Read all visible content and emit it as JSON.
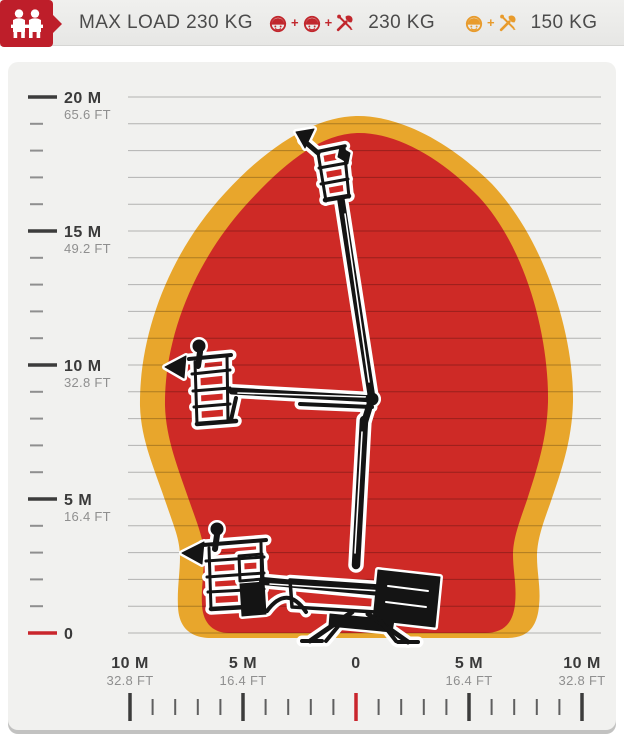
{
  "header": {
    "max_load_text": "MAX LOAD 230 KG",
    "plus": "+",
    "capacities": [
      {
        "formula": "worker + worker + tools",
        "value": "230 KG",
        "color": "#C1272D"
      },
      {
        "formula": "worker + tools",
        "value": "150 KG",
        "color": "#E89B2C"
      }
    ]
  },
  "chart_data": {
    "type": "area",
    "title": "Aerial work platform working envelope (height vs outreach)",
    "grid": true,
    "x_axis": {
      "unit": "M / FT",
      "range_m": [
        -10,
        10
      ],
      "minor_step_m": 1,
      "ticks": [
        {
          "v": -10,
          "m": "10 M",
          "ft": "32.8 FT"
        },
        {
          "v": -5,
          "m": "5 M",
          "ft": "16.4 FT"
        },
        {
          "v": 0,
          "m": "0",
          "ft": ""
        },
        {
          "v": 5,
          "m": "5 M",
          "ft": "16.4 FT"
        },
        {
          "v": 10,
          "m": "10 M",
          "ft": "32.8 FT"
        }
      ]
    },
    "y_axis": {
      "unit": "M / FT",
      "range_m": [
        0,
        20
      ],
      "minor_step_m": 1,
      "ticks": [
        {
          "v": 20,
          "m": "20 M",
          "ft": "65.6 FT"
        },
        {
          "v": 15,
          "m": "15 M",
          "ft": "49.2 FT"
        },
        {
          "v": 10,
          "m": "10 M",
          "ft": "32.8 FT"
        },
        {
          "v": 5,
          "m": "5 M",
          "ft": "16.4 FT"
        },
        {
          "v": 0,
          "m": "0",
          "ft": ""
        }
      ]
    },
    "series": [
      {
        "name": "150 kg restricted zone (outer band)",
        "color": "#E8A62C",
        "max_height_m": 20,
        "max_outreach_m": 9.6,
        "boundary_points_outreach_height_m": [
          [
            0,
            20
          ],
          [
            6,
            18
          ],
          [
            9,
            12
          ],
          [
            9.6,
            9
          ],
          [
            8,
            3.5
          ],
          [
            7.9,
            1
          ],
          [
            6.5,
            0
          ]
        ]
      },
      {
        "name": "230 kg work zone (inner area)",
        "color": "#CE2A26",
        "max_height_m": 18.7,
        "max_outreach_m": 8.5,
        "boundary_points_outreach_height_m": [
          [
            0,
            18.7
          ],
          [
            5.5,
            17
          ],
          [
            8,
            12
          ],
          [
            8.5,
            9
          ],
          [
            7,
            3.5
          ],
          [
            6.9,
            1
          ],
          [
            5.6,
            0
          ]
        ]
      }
    ],
    "overlay": "boom lift silhouette shown stowed, at mid outreach and fully elevated"
  },
  "colors": {
    "badge_red": "#BE1E2A",
    "zone_red": "#CE2A26",
    "zone_yellow": "#E8A62C",
    "zero_tick_red": "#C9252C",
    "panel_bg": "#F1F1EF",
    "text_dark": "#4B4B4B",
    "text_gray": "#8F8F8F"
  }
}
